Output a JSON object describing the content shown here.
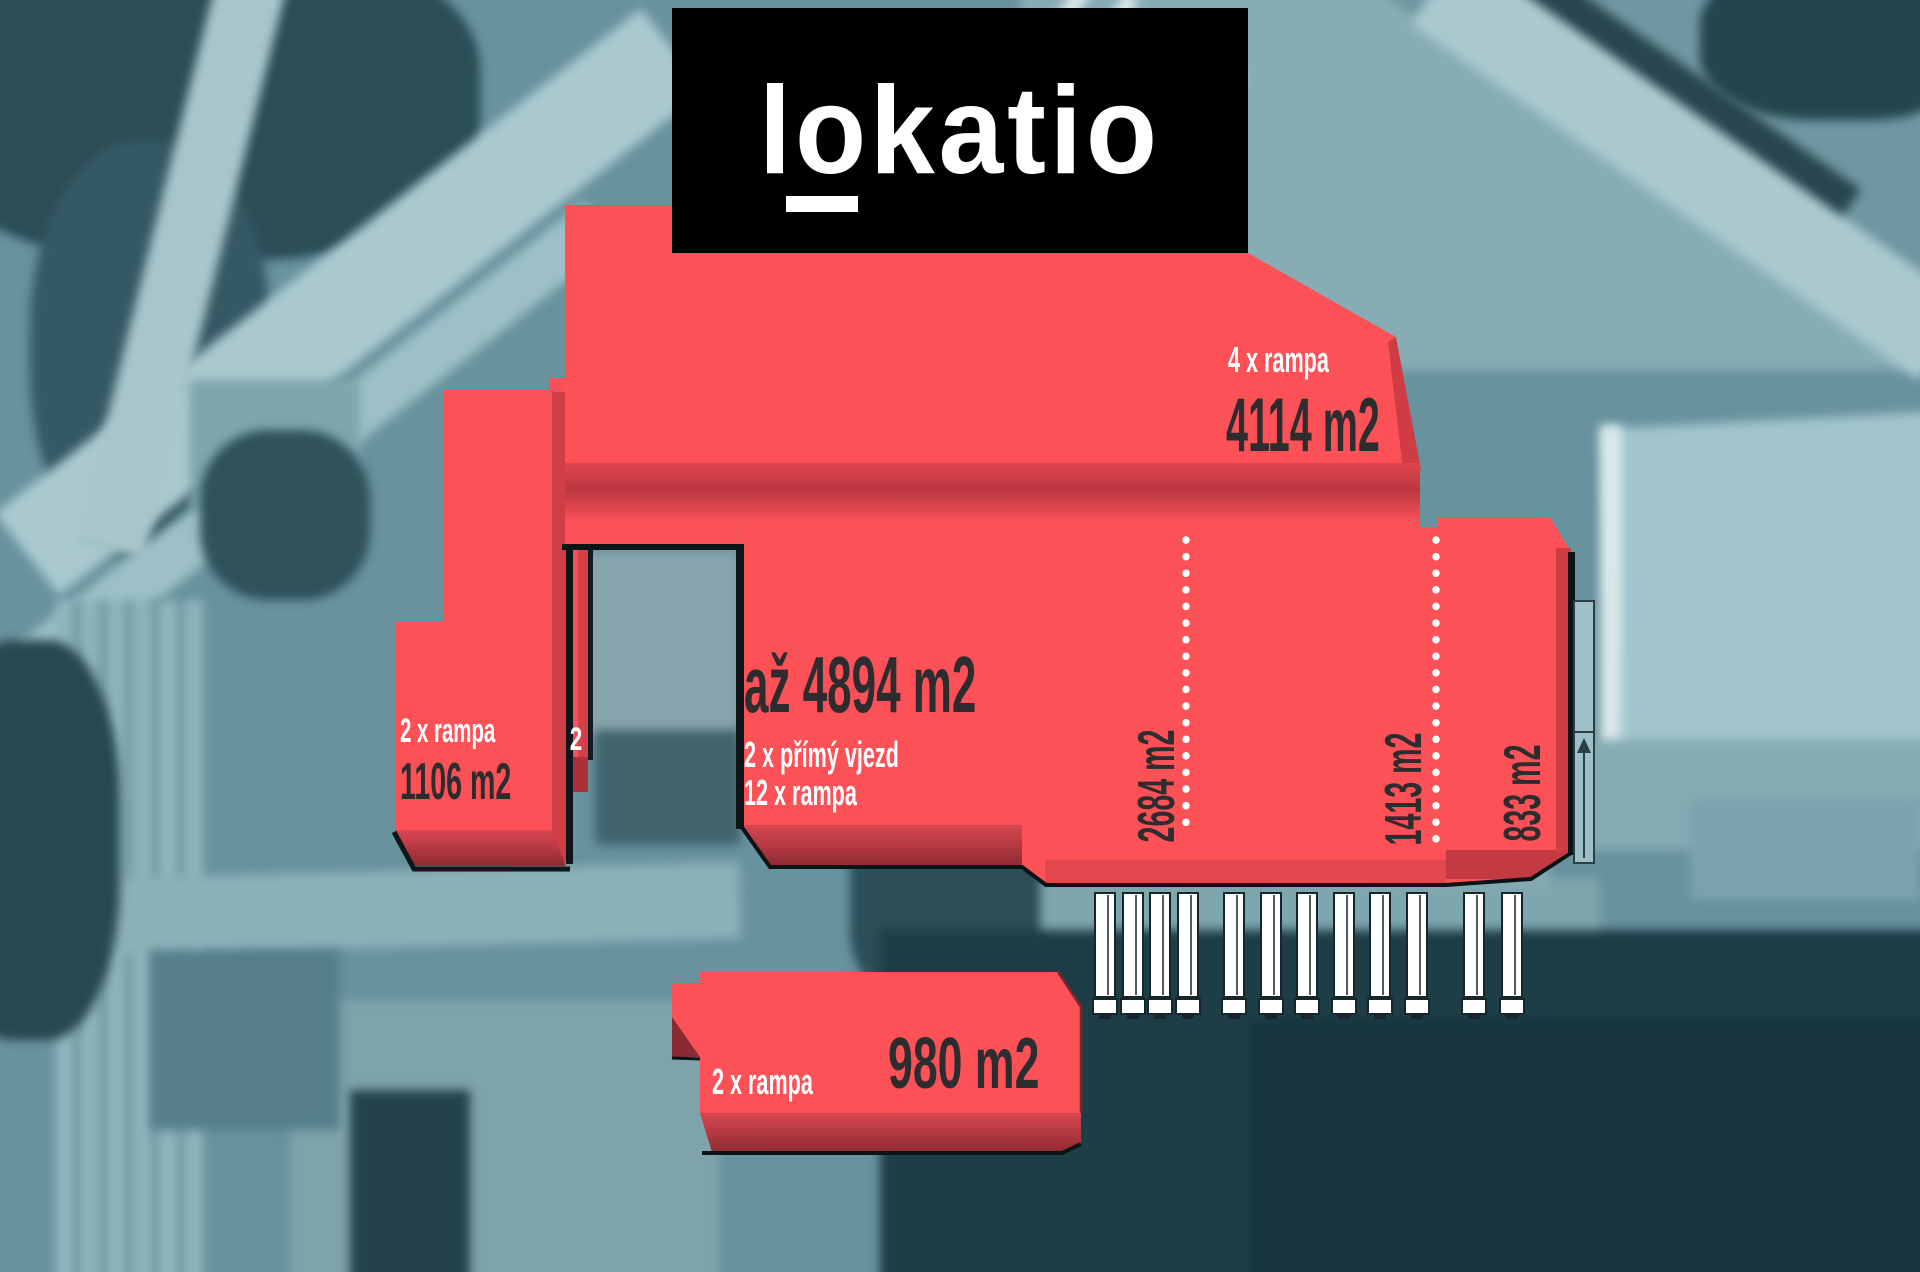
{
  "page": {
    "type": "aerial-site-plan-marketing-overlay",
    "size": "1920x1272"
  },
  "logo": {
    "text": "lokatio"
  },
  "buildings": {
    "top": {
      "rampa": "4 x rampa",
      "area": "4114 m2"
    },
    "main": {
      "area": "až 4894 m2",
      "entry": "2 x přímý vjezd",
      "rampa": "12 x rampa",
      "sections": {
        "s1": "2684 m2",
        "s2": "1413 m2",
        "s3": "833 m2"
      }
    },
    "left": {
      "rampa": "2 x rampa",
      "area": "1106 m2",
      "partial_label": "2"
    },
    "bottom": {
      "rampa": "2 x rampa",
      "area": "980 m2"
    }
  },
  "overlay": {
    "dotted_dividers": 2,
    "truck_dock_count": 12,
    "dock_panel_count": 2,
    "ramp_arrow_count": 1
  },
  "colors": {
    "overlay_red": "#fb5157",
    "overlay_red_face": "#cf3d45",
    "overlay_red_shadow": "#8f2b32",
    "outline_black": "#0c1418",
    "label_dark": "#2d2d30",
    "label_light": "#ffffff",
    "logo_bg": "#000000",
    "logo_text": "#ffffff",
    "photo_tint_base": "#68929d",
    "photo_dark": "#1d3d47",
    "photo_road": "#a9c9cf",
    "dotted_line": "#ffffff",
    "dock_panel": "#9dbfc6",
    "truck_icon": "#ffffff"
  }
}
